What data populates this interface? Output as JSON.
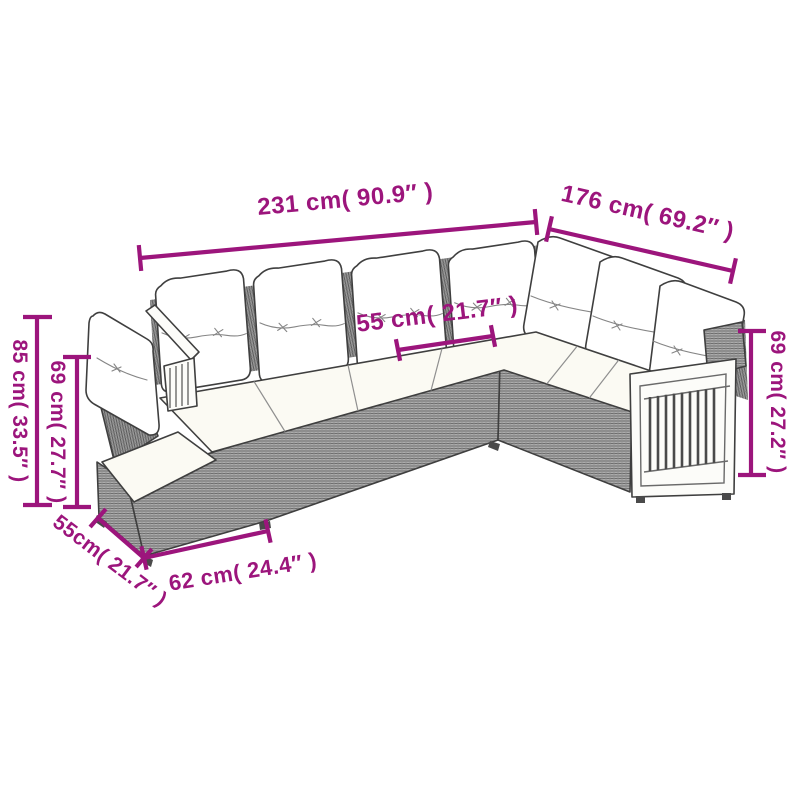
{
  "figure": {
    "description": "Dimension diagram of a gray rattan corner sofa set with white cushions and wood slat armrests"
  },
  "colors": {
    "dimension_annotation": "#9C157C",
    "sofa_outline": "#3F3F3F",
    "wicker_gray": "#ACACAC",
    "cushion_white": "#FFFFFF",
    "seat_cream": "#FBFAF3",
    "background": "#FFFFFF"
  },
  "dimensions": {
    "main_width": "231 cm( 90.9″ )",
    "right_width": "176 cm( 69.2″ )",
    "seat_width": "55 cm( 21.7″ )",
    "back_height_right": "69 cm( 27.2″ )",
    "total_height_left": "85 cm( 33.5″ )",
    "back_height_left": "69 cm( 27.7″ )",
    "module_depth": "55cm( 21.7″ )",
    "module_width": "62 cm( 24.4″ )"
  }
}
